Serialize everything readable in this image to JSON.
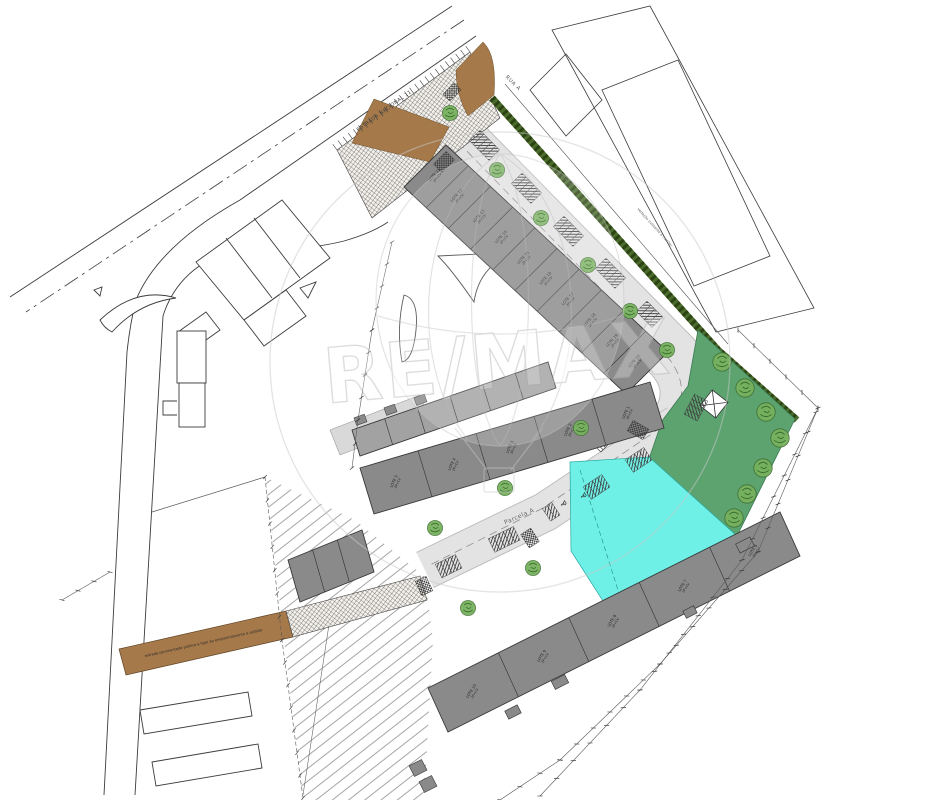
{
  "watermark": {
    "text": "RE/MAX"
  },
  "roads": {
    "estrada_nacional": "ESTRADA NACIONAL 11",
    "rua_a": "RUA A",
    "parcela_a": "Parcela A"
  },
  "notes": {
    "hedge": "vedação existente a manter",
    "access": "estrada pavimentada pública a ligar ao empreendimento a asfaltar"
  },
  "lots": {
    "floors_label": "2P+CV",
    "row_top": [
      "LOTE 11",
      "LOTE 12",
      "LOTE 13",
      "LOTE 14",
      "LOTE 15",
      "LOTE 16",
      "LOTE 17",
      "LOTE 18",
      "LOTE 19",
      "LOTE 20"
    ],
    "row_middle": [
      "LOTE 5",
      "LOTE 4",
      "LOTE 3",
      "LOTE 2",
      "LOTE 1"
    ],
    "row_bottom": [
      "LOTE 10",
      "LOTE 9",
      "LOTE 8",
      "LOTE 7",
      "LOTE 6"
    ]
  },
  "icons": {
    "accessible_parking": "♿"
  },
  "colors": {
    "park_green": "#5ca36f",
    "hedge_green": "#42601f",
    "water_cyan": "#6ff0e7",
    "earth_brown": "#a5794a",
    "building_gray": "#8a8a8a",
    "building_gray_light": "#a2a2a2",
    "road_gray": "#e3e3e3",
    "tree_green": "#77b15e",
    "line_dark": "#3c3c3c",
    "watermark_gray": "#c9c9c9"
  }
}
